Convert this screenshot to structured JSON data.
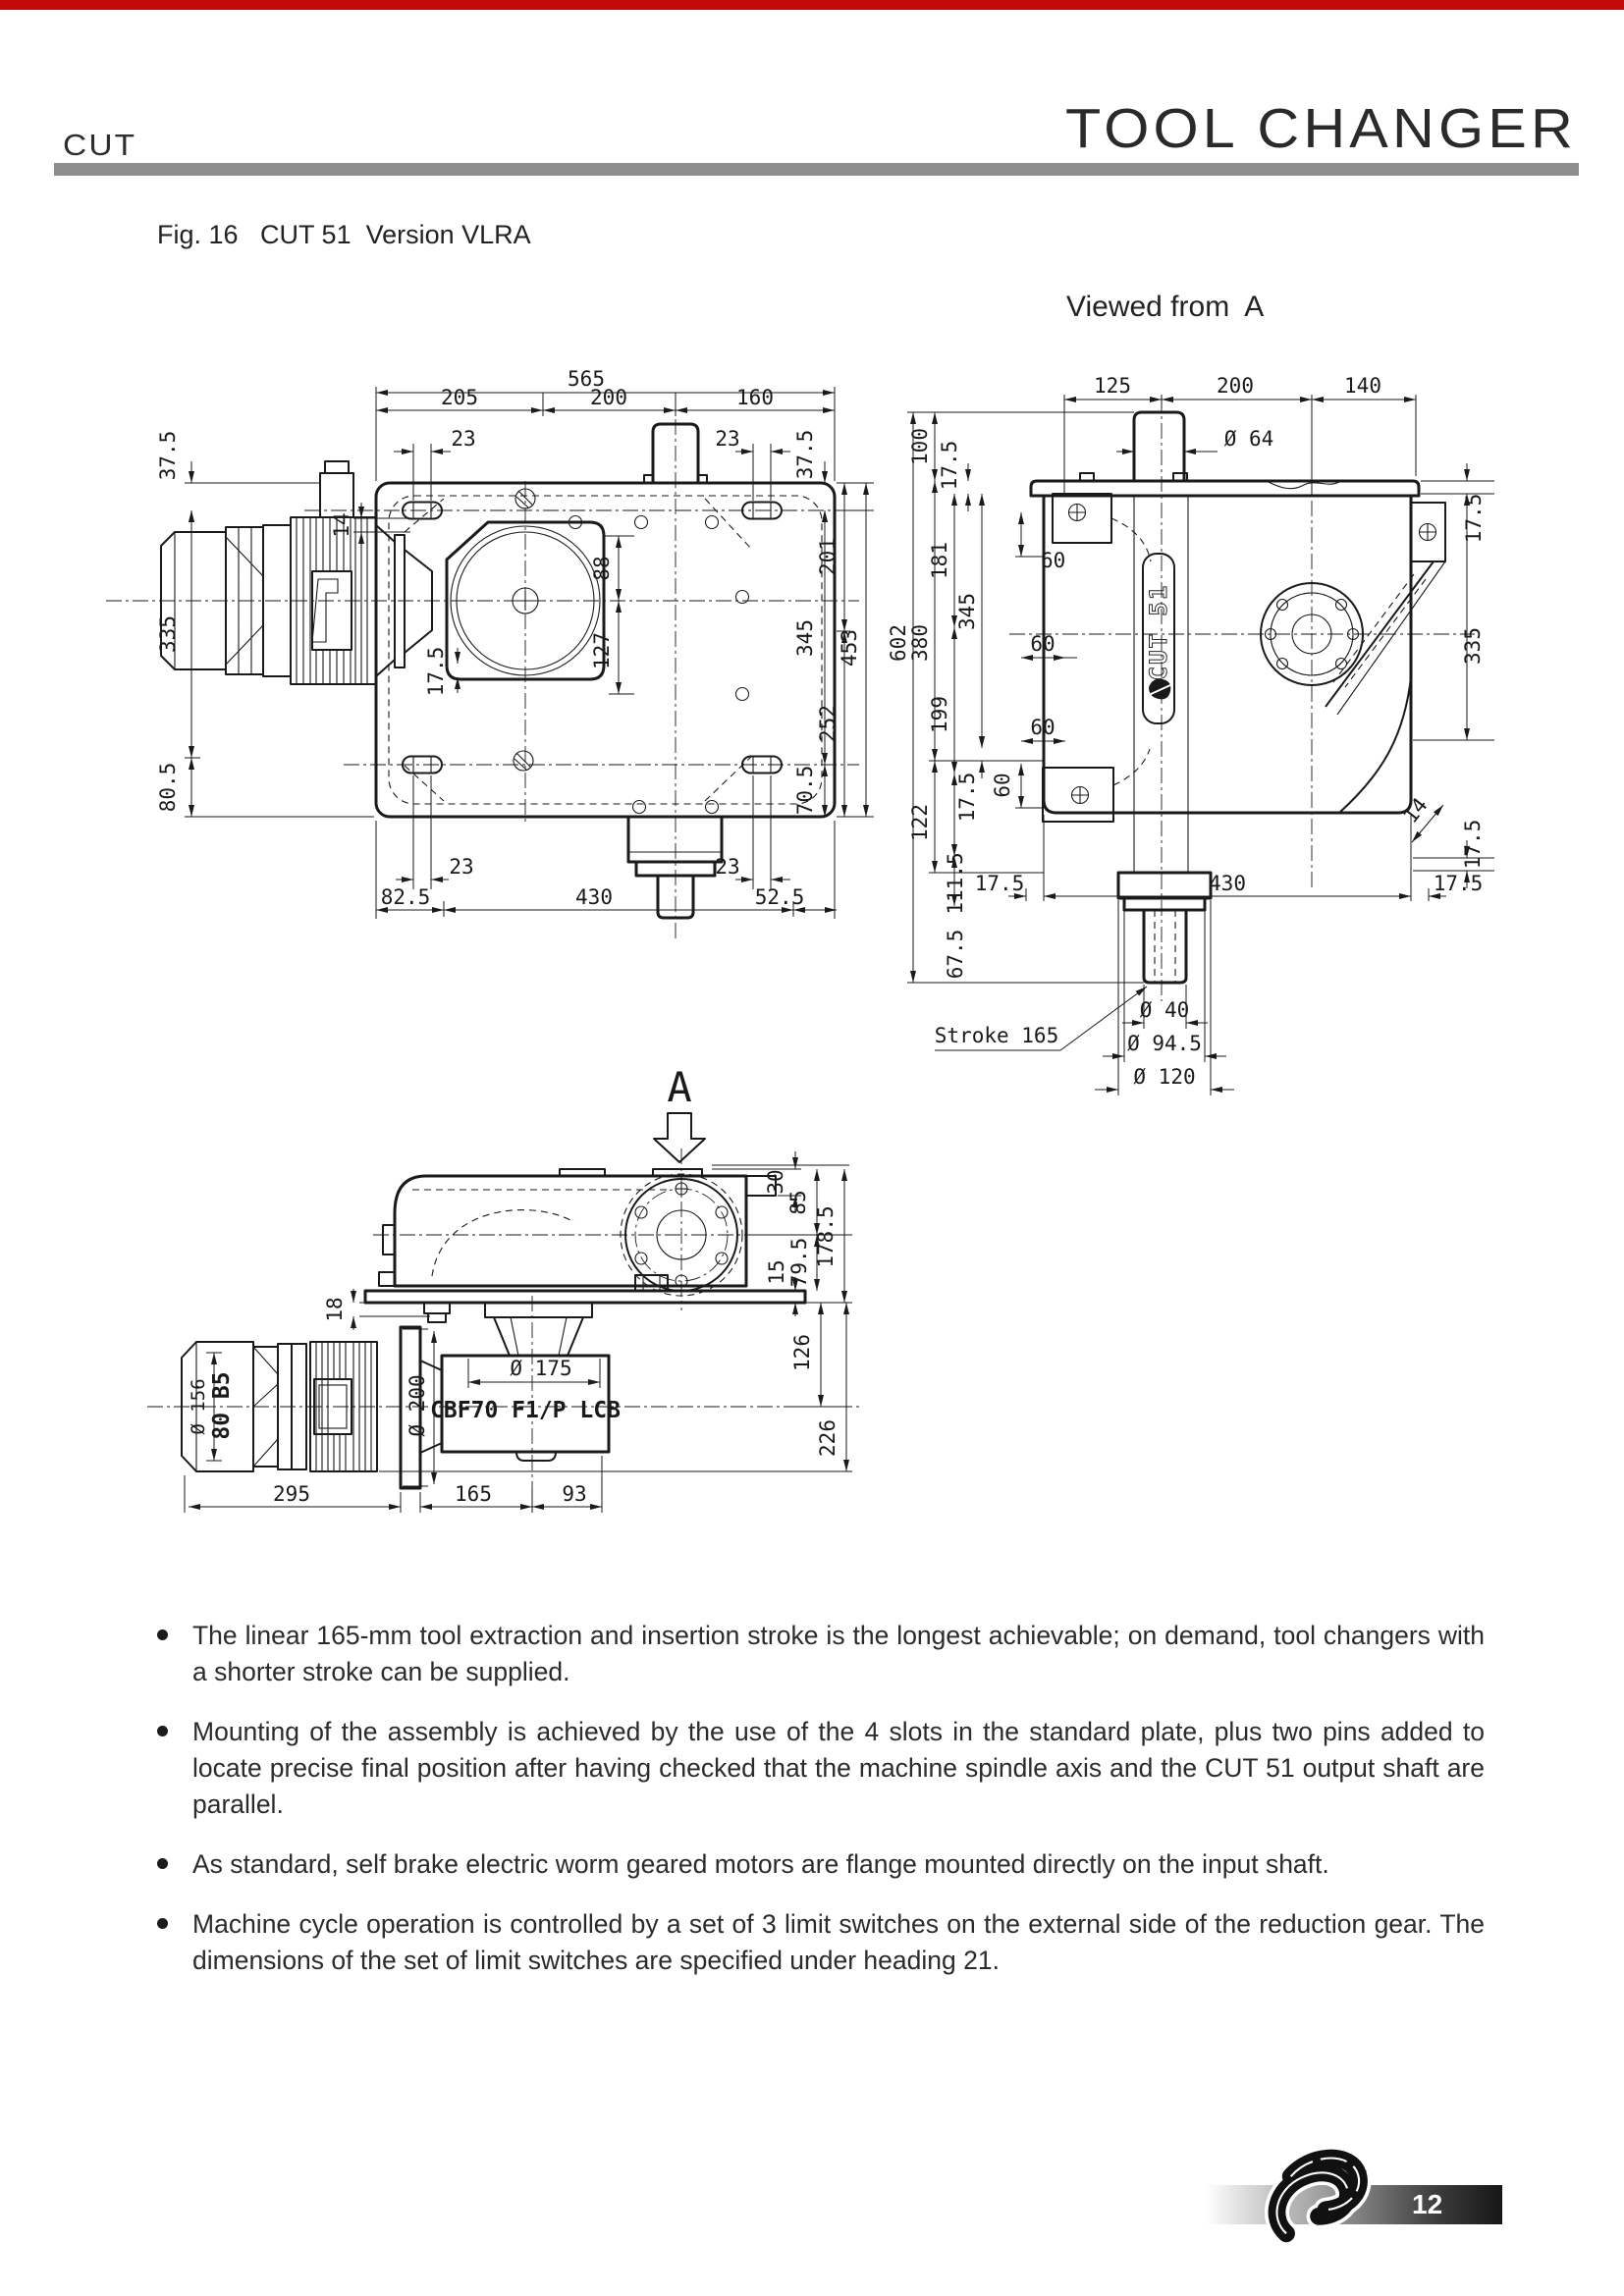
{
  "page": {
    "top_bar_color": "#c20a0a",
    "header": {
      "product_code": "CUT",
      "title": "TOOL CHANGER"
    },
    "figure_caption": "Fig. 16   CUT 51  Version VLRA",
    "view_from_label": "Viewed from  A",
    "footer": {
      "page_number": "12"
    }
  },
  "bullets": [
    "The linear 165-mm tool extraction and insertion stroke is the longest achievable; on demand, tool changers with a shorter stroke can be supplied.",
    "Mounting of the assembly is achieved by the use of the 4 slots in the standard plate, plus two pins added to locate precise final position after having checked that the machine spindle axis and the CUT 51 output shaft are parallel.",
    "As standard, self brake electric worm geared motors are flange mounted directly on the input shaft.",
    "Machine cycle operation is controlled by a set of 3 limit switches on the external side of the reduction gear. The dimensions of the set of limit switches are specified under heading 21."
  ],
  "drawings": {
    "top_view": {
      "name": "CUT 51 plan view",
      "labels": [
        "565",
        "205",
        "200",
        "160",
        "23",
        "23",
        "37.5",
        "335",
        "80.5",
        "14",
        "17.5",
        "88",
        "127",
        "37.5",
        "345",
        "70.5",
        "201",
        "252",
        "453",
        "23",
        "23",
        "82.5",
        "430",
        "52.5"
      ]
    },
    "front_view": {
      "name": "Viewed from A",
      "labels": [
        "125",
        "200",
        "140",
        "Ø 64",
        "100",
        "17.5",
        "380",
        "602",
        "181",
        "199",
        "111.5",
        "122",
        "345",
        "17.5",
        "60",
        "60",
        "60",
        "60",
        "67.5",
        "17.5",
        "430",
        "17.5",
        "17.5",
        "335",
        "14",
        "17.5",
        "Stroke 165",
        "Ø 40",
        "Ø 94.5",
        "Ø 120",
        "CUT 51"
      ]
    },
    "side_view": {
      "name": "Side view with geared motor",
      "labels": [
        "A",
        "30",
        "85",
        "178.5",
        "79.5",
        "15",
        "126",
        "226",
        "18",
        "Ø 200",
        "Ø 175",
        "CBF70 F1/P LCB",
        "Ø 156",
        "80 B5",
        "295",
        "165",
        "93"
      ]
    }
  }
}
